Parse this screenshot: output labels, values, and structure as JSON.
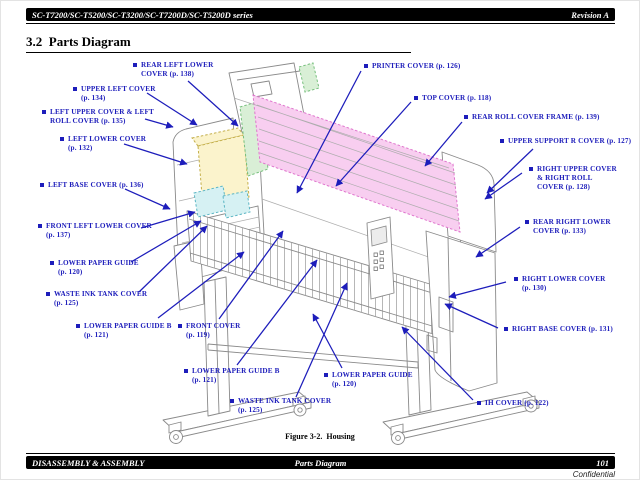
{
  "header": {
    "series": "SC-T7200/SC-T5200/SC-T3200/SC-T7200D/SC-T5200D series",
    "revision": "Revision A"
  },
  "section": {
    "title": "3.2  Parts Diagram"
  },
  "figure": {
    "caption": "Figure 3-2.  Housing"
  },
  "footer": {
    "left": "DISASSEMBLY & ASSEMBLY",
    "center": "Parts Diagram",
    "page_number": "101",
    "watermark": "Confidential"
  },
  "colors": {
    "callout_blue": "#1d1dbb",
    "hl_pink": "#f8cef0",
    "hl_pink_edge": "#df76cd",
    "hl_green": "#d9efd6",
    "hl_green_edge": "#76bf7c",
    "hl_yellow": "#fbf3cc",
    "hl_yellow_edge": "#c3ae49",
    "hl_cyan": "#d6f1f3",
    "hl_cyan_edge": "#5cb6c4"
  },
  "callouts": [
    {
      "id": "rear-left-lower-cover",
      "x": 131,
      "y": 60,
      "lines": [
        "REAR LEFT LOWER",
        "COVER (p. 138)"
      ],
      "arrows": [
        [
          187,
          80,
          237,
          125
        ]
      ]
    },
    {
      "id": "upper-left-cover",
      "x": 71,
      "y": 84,
      "lines": [
        "UPPER LEFT COVER",
        "(p. 134)"
      ],
      "arrows": [
        [
          146,
          92,
          196,
          124
        ]
      ]
    },
    {
      "id": "left-upper-cover-left-roll-cover",
      "x": 40,
      "y": 107,
      "lines": [
        "LEFT UPPER COVER & LEFT",
        "ROLL COVER (p. 135)"
      ],
      "arrows": [
        [
          144,
          118,
          172,
          126
        ]
      ]
    },
    {
      "id": "left-lower-cover",
      "x": 58,
      "y": 134,
      "lines": [
        "LEFT LOWER COVER",
        "(p. 132)"
      ],
      "arrows": [
        [
          123,
          143,
          186,
          163
        ]
      ]
    },
    {
      "id": "left-base-cover",
      "x": 38,
      "y": 180,
      "lines": [
        "LEFT BASE COVER (p. 136)"
      ],
      "arrows": [
        [
          124,
          188,
          169,
          208
        ]
      ]
    },
    {
      "id": "front-left-lower-cover",
      "x": 36,
      "y": 221,
      "lines": [
        "FRONT LEFT LOWER COVER",
        "(p. 137)"
      ],
      "arrows": [
        [
          140,
          227,
          194,
          211
        ]
      ]
    },
    {
      "id": "lower-paper-guide-left",
      "x": 48,
      "y": 258,
      "lines": [
        "LOWER PAPER GUIDE",
        "(p. 120)"
      ],
      "arrows": [
        [
          130,
          261,
          200,
          220
        ]
      ]
    },
    {
      "id": "waste-ink-tank-cover-left",
      "x": 44,
      "y": 289,
      "lines": [
        "WASTE INK TANK COVER",
        "(p. 125)"
      ],
      "arrows": [
        [
          138,
          291,
          206,
          225
        ]
      ]
    },
    {
      "id": "lower-paper-guide-b-left",
      "x": 74,
      "y": 321,
      "lines": [
        "LOWER PAPER GUIDE B",
        "(p. 121)"
      ],
      "arrows": [
        [
          157,
          317,
          243,
          251
        ]
      ]
    },
    {
      "id": "front-cover",
      "x": 176,
      "y": 321,
      "lines": [
        "FRONT COVER",
        "(p. 119)"
      ],
      "arrows": [
        [
          218,
          318,
          282,
          230
        ]
      ]
    },
    {
      "id": "lower-paper-guide-b-center",
      "x": 182,
      "y": 366,
      "lines": [
        "LOWER PAPER GUIDE B",
        "(p. 121)"
      ],
      "arrows": [
        [
          236,
          364,
          316,
          259
        ]
      ]
    },
    {
      "id": "waste-ink-tank-cover-center",
      "x": 228,
      "y": 396,
      "lines": [
        "WASTE INK TANK COVER",
        "(p. 125)"
      ],
      "arrows": [
        [
          295,
          396,
          346,
          282
        ]
      ]
    },
    {
      "id": "lower-paper-guide-bottom",
      "x": 322,
      "y": 370,
      "lines": [
        "LOWER PAPER GUIDE",
        "(p. 120)"
      ],
      "arrows": [
        [
          341,
          367,
          312,
          313
        ]
      ]
    },
    {
      "id": "ih-cover",
      "x": 475,
      "y": 398,
      "lines": [
        "IH COVER (p. 122)"
      ],
      "arrows": [
        [
          472,
          399,
          401,
          326
        ]
      ]
    },
    {
      "id": "printer-cover",
      "x": 362,
      "y": 61,
      "lines": [
        "PRINTER COVER (p. 126)"
      ],
      "arrows": [
        [
          360,
          70,
          296,
          192
        ]
      ]
    },
    {
      "id": "top-cover",
      "x": 412,
      "y": 93,
      "lines": [
        "TOP COVER (p. 118)"
      ],
      "arrows": [
        [
          410,
          101,
          335,
          185
        ]
      ]
    },
    {
      "id": "rear-roll-cover-frame",
      "x": 462,
      "y": 112,
      "lines": [
        "REAR ROLL COVER FRAME (p. 139)"
      ],
      "arrows": [
        [
          461,
          121,
          424,
          165
        ]
      ]
    },
    {
      "id": "upper-support-r-cover",
      "x": 498,
      "y": 136,
      "lines": [
        "UPPER SUPPORT R COVER (p. 127)"
      ],
      "arrows": [
        [
          532,
          148,
          486,
          192
        ]
      ]
    },
    {
      "id": "right-upper-cover-right-roll-cover",
      "x": 527,
      "y": 164,
      "lines": [
        "RIGHT UPPER COVER",
        "& RIGHT ROLL",
        "COVER (p. 128)"
      ],
      "arrows": [
        [
          521,
          172,
          484,
          198
        ]
      ]
    },
    {
      "id": "rear-right-lower-cover",
      "x": 523,
      "y": 217,
      "lines": [
        "REAR RIGHT LOWER",
        "COVER (p. 133)"
      ],
      "arrows": [
        [
          519,
          226,
          475,
          256
        ]
      ]
    },
    {
      "id": "right-lower-cover",
      "x": 512,
      "y": 274,
      "lines": [
        "RIGHT LOWER COVER",
        "(p. 130)"
      ],
      "arrows": [
        [
          505,
          281,
          448,
          296
        ]
      ]
    },
    {
      "id": "right-base-cover",
      "x": 502,
      "y": 324,
      "lines": [
        "RIGHT BASE COVER (p. 131)"
      ],
      "arrows": [
        [
          497,
          327,
          444,
          303
        ]
      ]
    }
  ]
}
